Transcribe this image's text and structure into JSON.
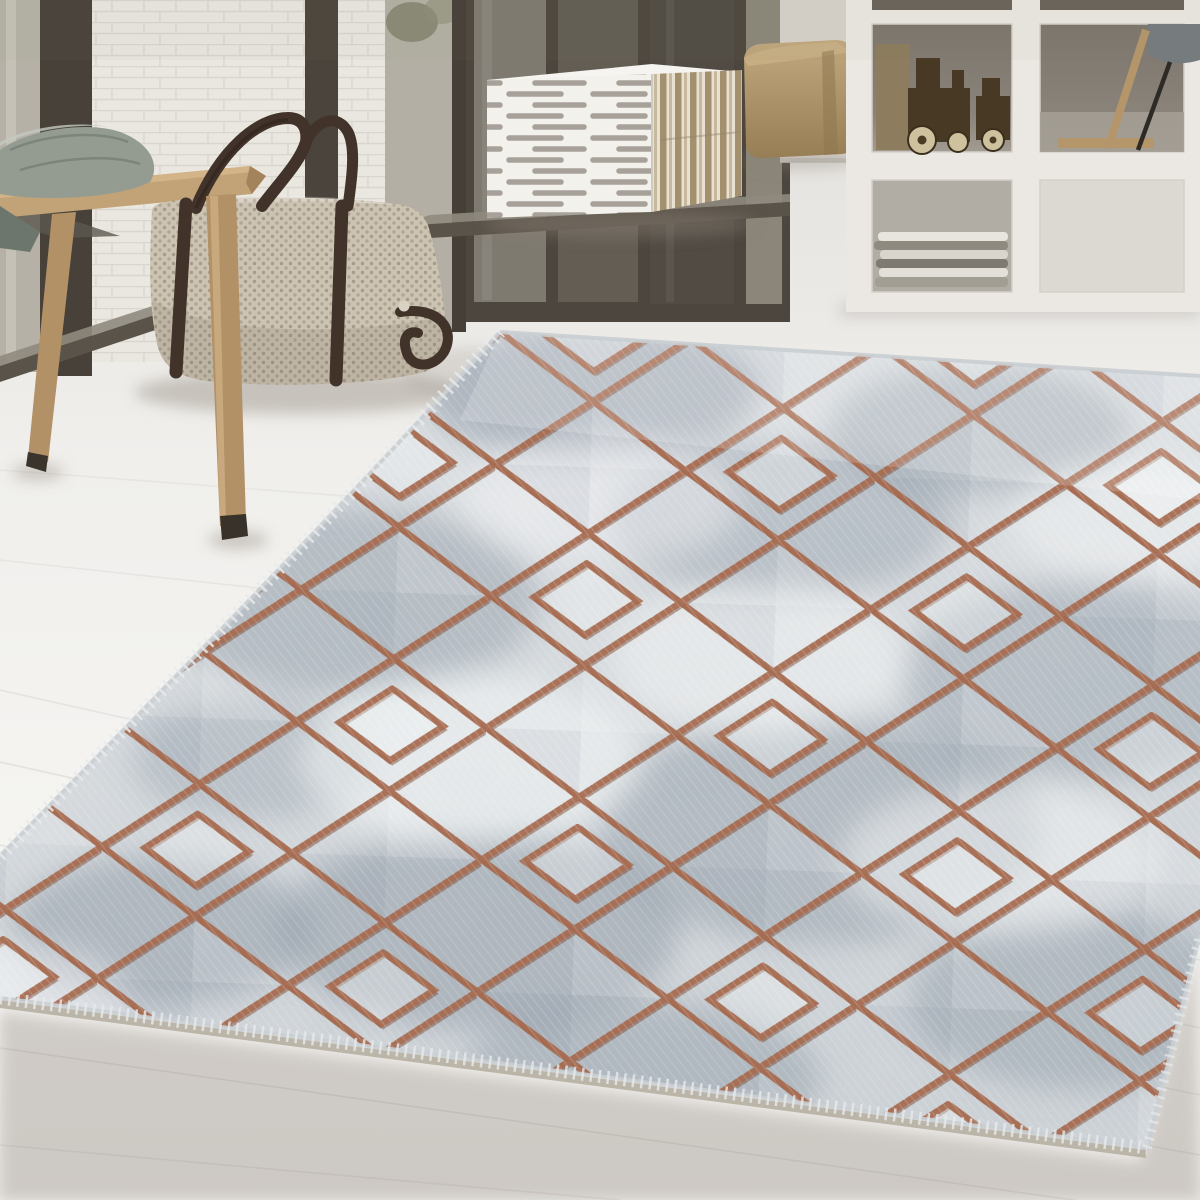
{
  "meta": {
    "type": "product-lifestyle-photo",
    "subject": "grey marble-look area rug with bronze diamond lattice pattern",
    "setting": "bright interior, whitewashed wood plank floor, white brick wall, glass doors, cube shelf"
  },
  "scene": {
    "objects": [
      "white-brick-wall",
      "glass-door-panels",
      "door-track",
      "wooden-bench",
      "sage-cushion",
      "woven-duffel-bag",
      "striped-cube-ottoman",
      "tan-cube-pouf",
      "white-cube-shelf",
      "wooden-toy-cameras",
      "magazine-stack",
      "easel-reflection",
      "whitewashed-plank-floor",
      "diamond-pattern-rug"
    ]
  },
  "colors": {
    "floor_far": "#e5e3df",
    "floor_mid": "#f0efec",
    "floor_near": "#f5f4f1",
    "floor_fore": "#edebe8",
    "plank_seam": "#d8d4cf",
    "brick": "#eae7e1",
    "mortar": "#d8d4cd",
    "frame_dark": "#47413a",
    "glass_light": "#b5b1a6",
    "glass_mid": "#7f7a70",
    "wall_right": "#d7d2ca",
    "door_track": "#5a5349",
    "shelf_frame": "#ebe8e3",
    "shelf_cell_dark": "#8a837a",
    "shelf_cell_mid": "#b2ada4",
    "shelf_cell_bright": "#dcd9d3",
    "pouf_top": "#c2a87e",
    "pouf_bottom": "#967d53",
    "cube_white": "#f3f1ec",
    "cube_stripe": "#a7a199",
    "cube_side_light": "#e8e1d1",
    "cube_side_dark": "#a3906f",
    "bench_wood": "#c2a277",
    "bench_leg": "#b29167",
    "cushion": "#949c92",
    "cushion_shadow": "#6d766c",
    "bag_base": "#ccc3b2",
    "bag_dot": "#a69c8a",
    "strap": "#42332a",
    "toy_wood": "#473923",
    "toy_wheel": "#cdc19e",
    "magazine_light": "#e8e5df",
    "magazine_dark": "#8f8a80",
    "rug_top": "#dfe2e4",
    "rug_bottom": "#ced3d7",
    "rug_marble": "#8d98a4",
    "rug_copper": "#a5684c",
    "rug_copper_dark": "#7c4a34",
    "rug_fringe": "#e7eaec",
    "rug_pile_edge": "#b3ab9e",
    "shadow": "#8b8279",
    "greenery": "#7e816c",
    "easel_wood": "#b5966a",
    "stick_dark": "#2e2b27",
    "chair_gray": "#757b7f"
  }
}
